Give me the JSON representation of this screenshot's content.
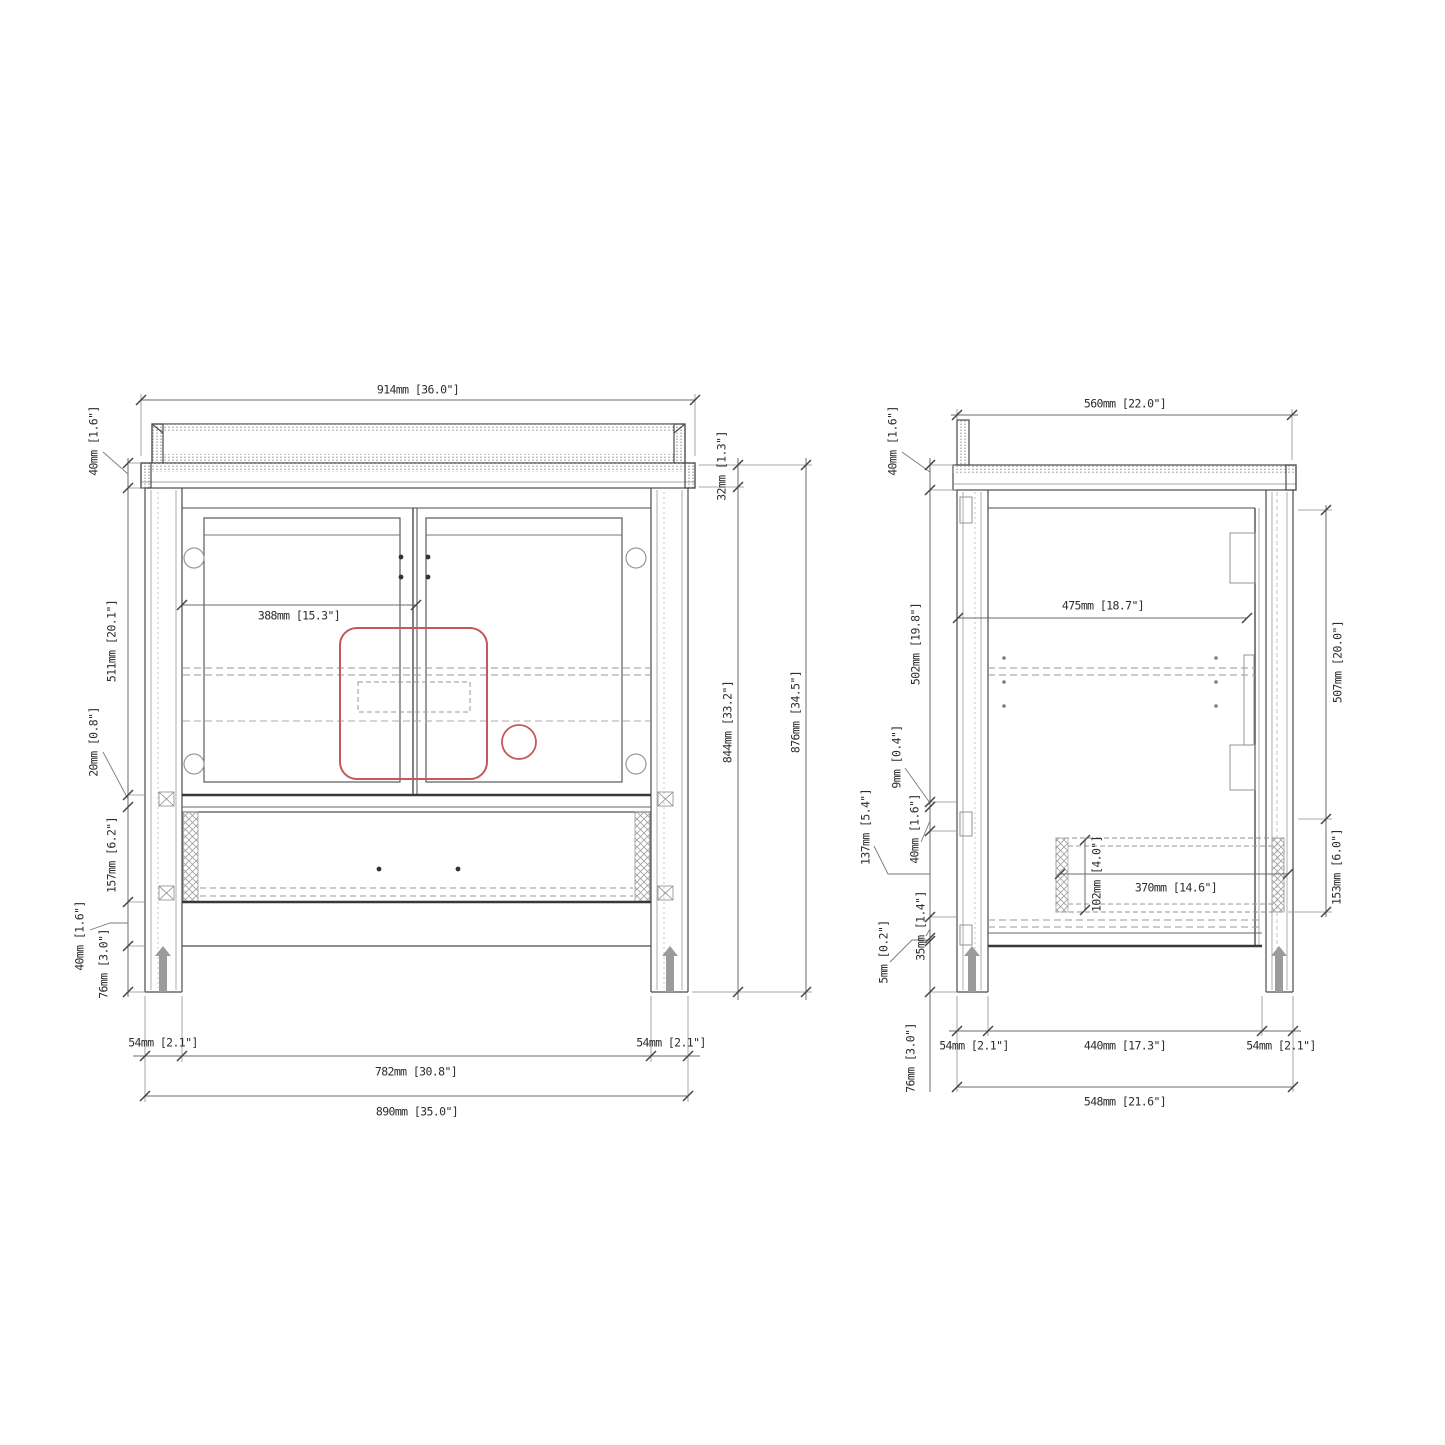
{
  "drawing": {
    "type": "vanity-cabinet-technical-drawing",
    "colors": {
      "line": "#4b4b4b",
      "thick_line": "#383838",
      "light_line": "#8a8a8a",
      "accent_red": "#c4585a"
    }
  },
  "front_view": {
    "overall_width": "914mm [36.0\"]",
    "countertop_thickness": "40mm [1.6\"]",
    "door_section_height": "511mm [20.1\"]",
    "mid_rail_height": "20mm [0.8\"]",
    "drawer_section_height": "157mm [6.2\"]",
    "bottom_rail_height": "40mm [1.6\"]",
    "foot_height": "76mm [3.0\"]",
    "left_leg_width": "54mm [2.1\"]",
    "right_leg_width": "54mm [2.1\"]",
    "inner_width": "782mm [30.8\"]",
    "base_width": "890mm [35.0\"]",
    "sink_center_offset": "388mm [15.3\"]",
    "top_thickness": "32mm [1.3\"]",
    "cabinet_body_height": "844mm [33.2\"]",
    "overall_height": "876mm [34.5\"]"
  },
  "side_view": {
    "overall_depth": "560mm [22.0\"]",
    "countertop_thickness": "40mm [1.6\"]",
    "interior_height": "502mm [19.8\"]",
    "panel_gap": "9mm [0.4\"]",
    "rail_height": "40mm [1.6\"]",
    "drawer_box_height": "137mm [5.4\"]",
    "shelf_thickness": "35mm [1.4\"]",
    "bottom_gap": "5mm [0.2\"]",
    "foot_height": "76mm [3.0\"]",
    "interior_depth": "475mm [18.7\"]",
    "drawer_side_height": "102mm [4.0\"]",
    "drawer_depth": "370mm [14.6\"]",
    "door_panel_height": "507mm [20.0\"]",
    "drawer_front_height": "153mm [6.0\"]",
    "front_leg_depth": "54mm [2.1\"]",
    "leg_spacing": "440mm [17.3\"]",
    "back_leg_depth": "54mm [2.1\"]",
    "base_depth": "548mm [21.6\"]"
  }
}
